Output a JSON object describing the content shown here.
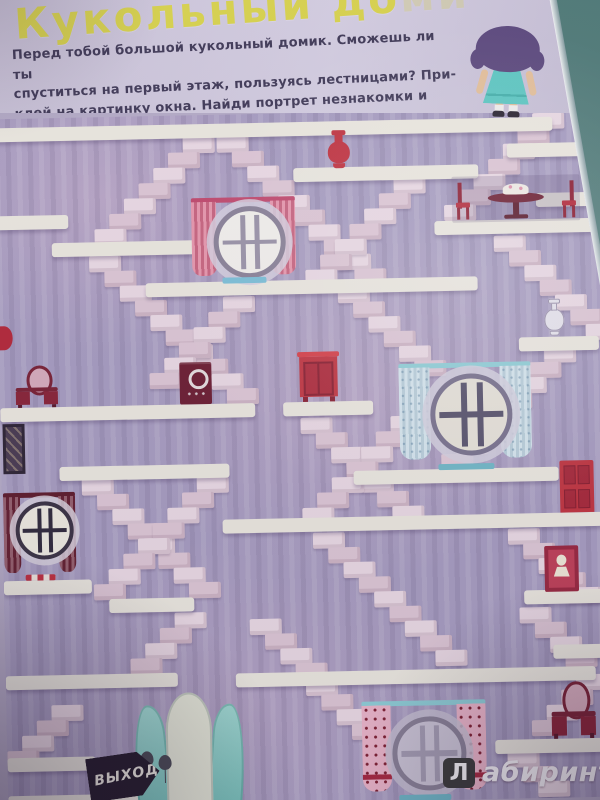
{
  "header": {
    "title_visible": "Кукольный до",
    "title_faded": "ми",
    "paragraph_lines": [
      "Перед тобой большой кукольный домик. Сможешь ли ты",
      "спуститься на первый этаж, пользуясь лестницами? При-",
      "клей на картинку окна. Найди портрет незнакомки и вазу",
      "с цветами."
    ]
  },
  "maze": {
    "exit_sign_label": "ВЫХОД",
    "floors": [
      [
        0,
        9,
        558
      ],
      [
        298,
        55,
        185
      ],
      [
        512,
        35,
        88
      ],
      [
        540,
        85,
        60
      ],
      [
        0,
        97,
        72
      ],
      [
        55,
        125,
        150
      ],
      [
        438,
        111,
        162
      ],
      [
        148,
        167,
        332
      ],
      [
        520,
        229,
        80
      ],
      [
        0,
        289,
        255
      ],
      [
        283,
        289,
        90
      ],
      [
        352,
        359,
        205
      ],
      [
        58,
        349,
        170
      ],
      [
        220,
        405,
        380
      ],
      [
        0,
        462,
        88
      ],
      [
        105,
        482,
        85
      ],
      [
        520,
        482,
        80
      ],
      [
        548,
        537,
        52
      ],
      [
        0,
        557,
        172
      ],
      [
        230,
        559,
        360
      ],
      [
        0,
        639,
        88
      ],
      [
        488,
        631,
        112
      ],
      [
        0,
        677,
        230
      ]
    ],
    "stairs": [
      [
        188,
        22,
        7,
        "dl"
      ],
      [
        222,
        22,
        10,
        "dr"
      ],
      [
        538,
        5,
        7,
        "dl"
      ],
      [
        398,
        67,
        7,
        "dl"
      ],
      [
        92,
        139,
        10,
        "dr"
      ],
      [
        225,
        182,
        6,
        "dl"
      ],
      [
        497,
        127,
        7,
        "dr"
      ],
      [
        340,
        175,
        6,
        "dr"
      ],
      [
        545,
        239,
        8,
        "dl"
      ],
      [
        80,
        362,
        8,
        "dr"
      ],
      [
        195,
        362,
        8,
        "dl"
      ],
      [
        300,
        305,
        7,
        "dr"
      ],
      [
        390,
        305,
        7,
        "dl"
      ],
      [
        310,
        420,
        9,
        "dr"
      ],
      [
        505,
        420,
        5,
        "dr"
      ],
      [
        515,
        499,
        4,
        "dr"
      ],
      [
        170,
        497,
        4,
        "dl"
      ],
      [
        245,
        505,
        4,
        "dr"
      ],
      [
        45,
        587,
        4,
        "dl"
      ],
      [
        300,
        567,
        4,
        "dr"
      ],
      [
        570,
        567,
        4,
        "dl"
      ],
      [
        500,
        643,
        3,
        "dr"
      ]
    ],
    "items": [
      {
        "type": "vase",
        "variant": "red",
        "name": "red-vase",
        "x": 331,
        "y": 18,
        "w": 26,
        "h": 39
      },
      {
        "type": "dining-set",
        "name": "dining-table-with-cake-and-chairs",
        "x": 456,
        "y": 67,
        "w": 128,
        "h": 46
      },
      {
        "type": "window",
        "variant": "pink",
        "name": "round-window-pink-curtains",
        "x": 193,
        "y": 83,
        "w": 108,
        "h": 86
      },
      {
        "type": "wall-sconce",
        "name": "red-wall-vase",
        "x": 0,
        "y": 202,
        "w": 14,
        "h": 34
      },
      {
        "type": "vanity",
        "name": "vanity-table-left",
        "x": 16,
        "y": 247,
        "w": 42,
        "h": 42
      },
      {
        "type": "stove",
        "name": "toy-stove",
        "x": 180,
        "y": 247,
        "w": 32,
        "h": 42
      },
      {
        "type": "red-wardrobe",
        "name": "red-wardrobe",
        "x": 300,
        "y": 239,
        "w": 38,
        "h": 50
      },
      {
        "type": "vase",
        "variant": "white",
        "name": "white-vase",
        "x": 545,
        "y": 191,
        "w": 22,
        "h": 38
      },
      {
        "type": "window",
        "variant": "blue",
        "name": "round-window-blue-curtains",
        "x": 396,
        "y": 253,
        "w": 138,
        "h": 107
      },
      {
        "type": "harp-picture",
        "name": "dark-framed-picture",
        "x": 2,
        "y": 305,
        "w": 22,
        "h": 50
      },
      {
        "type": "window",
        "variant": "maroon",
        "name": "round-window-maroon-curtains",
        "x": 0,
        "y": 374,
        "w": 74,
        "h": 88
      },
      {
        "type": "red-door",
        "name": "red-door",
        "x": 558,
        "y": 353,
        "w": 34,
        "h": 52
      },
      {
        "type": "portrait",
        "name": "lady-portrait",
        "x": 541,
        "y": 438,
        "w": 34,
        "h": 46
      },
      {
        "type": "vanity",
        "name": "vanity-table-bottom-right",
        "x": 545,
        "y": 574,
        "w": 44,
        "h": 57
      },
      {
        "type": "exit-door",
        "name": "teal-exit-double-door",
        "x": 126,
        "y": 577,
        "w": 112,
        "h": 113
      },
      {
        "type": "exit-sign",
        "name": "exit-sign",
        "x": 80,
        "y": 637,
        "w": 72,
        "h": 44
      },
      {
        "type": "window",
        "variant": "dotted",
        "name": "round-window-dotted-curtains",
        "x": 352,
        "y": 590,
        "w": 130,
        "h": 100
      }
    ]
  },
  "watermark": {
    "badge_letter": "Л",
    "text": "абиринт.ру"
  }
}
